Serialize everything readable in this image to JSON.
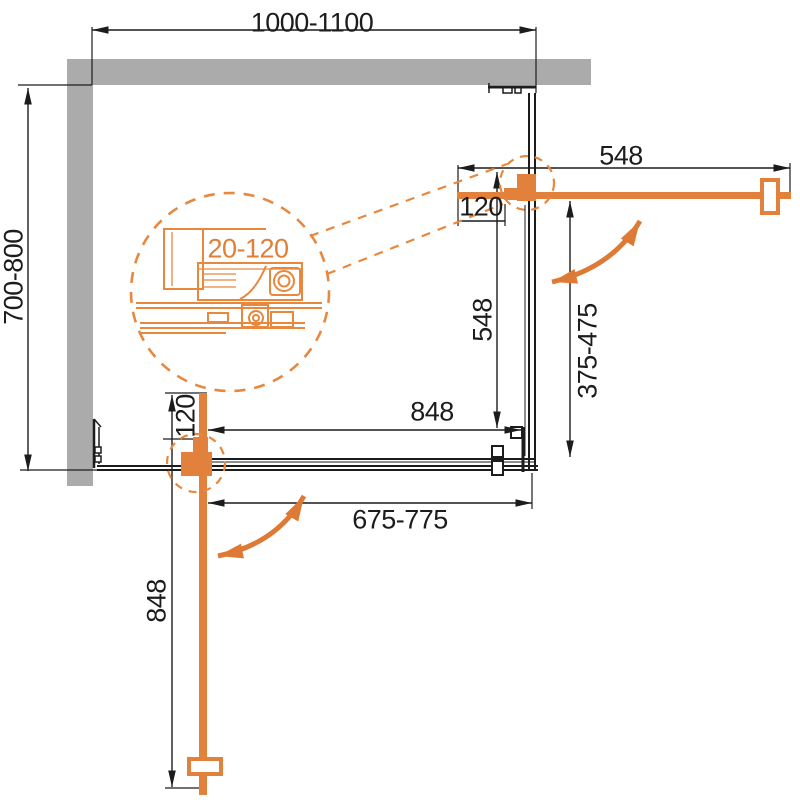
{
  "diagram_title": "corner shower enclosure installation plan",
  "labels": {
    "width_range": "1000-1100",
    "depth_range": "700-800",
    "top_door_width": "548",
    "top_wall_clearance": "120",
    "side_fixed_panel": "548",
    "side_entry_range": "375-475",
    "front_fixed_panel": "848",
    "front_entry_range": "675-775",
    "bottom_door_width": "848",
    "bottom_wall_clearance": "120",
    "profile_adjustment_range": "20-120"
  },
  "colors": {
    "wall_gray": "#ABABAB",
    "line_black": "#1C1C1C",
    "door_orange": "#E2813B",
    "detail_orange": "#E8883F",
    "detail_text_orange": "#E07F35"
  }
}
